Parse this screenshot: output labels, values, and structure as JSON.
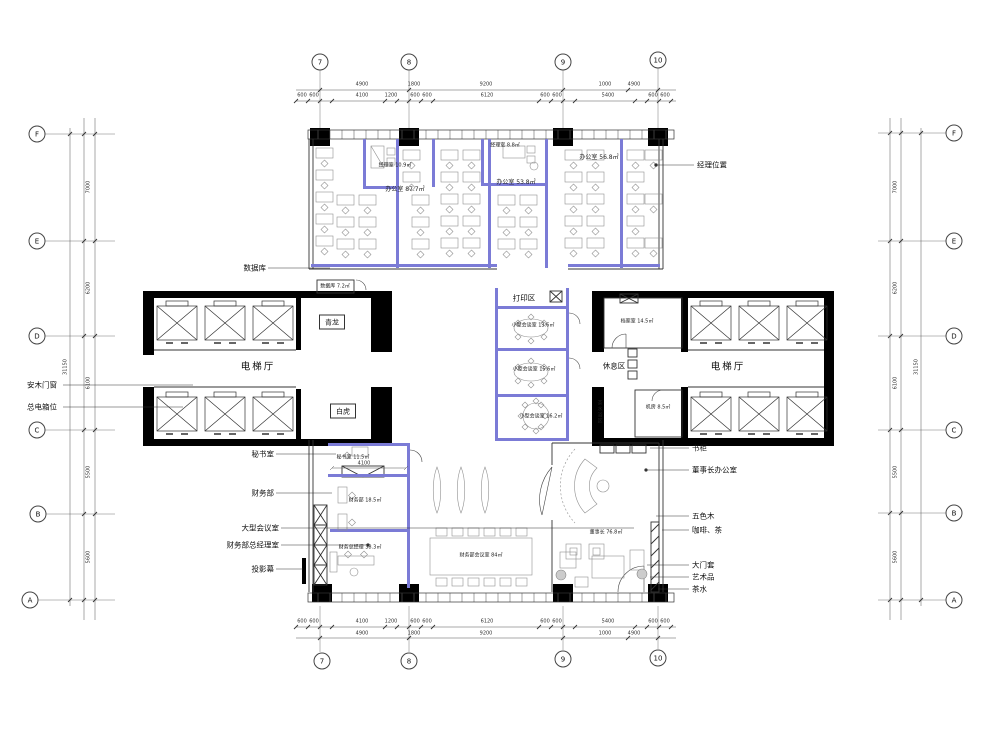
{
  "colors": {
    "wall": "#000000",
    "partition": "#7b7bd6",
    "line": "#333333",
    "furniture": "#909090",
    "bg": "#ffffff"
  },
  "axes": {
    "top": [
      "7",
      "8",
      "9",
      "10"
    ],
    "bottom": [
      "7",
      "8",
      "9",
      "10"
    ],
    "left": [
      "F",
      "E",
      "D",
      "C",
      "B",
      "A"
    ],
    "right": [
      "F",
      "E",
      "D",
      "C",
      "B",
      "A"
    ]
  },
  "dims": {
    "top_row1": [
      "4900",
      "1800",
      "9200",
      "1000",
      "4900"
    ],
    "top_row2": [
      "600",
      "600",
      "4100",
      "1200",
      "600",
      "600",
      "6120",
      "600",
      "600",
      "5400",
      "600",
      "600"
    ],
    "bottom_row1": [
      "600",
      "600",
      "4100",
      "1200",
      "600",
      "600",
      "6120",
      "600",
      "600",
      "5400",
      "600",
      "600"
    ],
    "bottom_row2": [
      "4900",
      "1800",
      "9200",
      "1000",
      "4900"
    ],
    "left_story": [
      "7000",
      "6200",
      "6100",
      "5500",
      "5600"
    ],
    "right_story": [
      "7000",
      "6200",
      "6100",
      "5500",
      "5600"
    ],
    "left_total": "31150",
    "right_total": "31150",
    "secretary_width": "4100"
  },
  "rooms": [
    "经理室 10.9㎡",
    "办公室 87.7㎡",
    "经理室 8.8㎡",
    "办公室 53.8㎡",
    "办公室 56.8㎡",
    "数据库 7.2㎡",
    "青龙",
    "白虎",
    "电梯厅",
    "秘书室 11.5㎡",
    "财务部 18.5㎡",
    "财务总经理 38.3㎡",
    "财务部会议室 84㎡",
    "打印区",
    "小型会谈室 13.6㎡",
    "小型会谈室 15.6㎡",
    "小型会谈室 16.2㎡",
    "休息区",
    "档案室 14.5㎡",
    "电梯厅",
    "机房 8.5㎡",
    "董事长 76.8㎡",
    "茶水浴区"
  ],
  "leaders": [
    "经理位置",
    "数据库",
    "安木门窗",
    "总电箱位",
    "秘书室",
    "财务部",
    "大型会议室",
    "财务部总经理室",
    "投影幕",
    "书柜",
    "董事长办公室",
    "五色木",
    "咖啡、茶",
    "大门套",
    "艺术品",
    "茶水"
  ]
}
